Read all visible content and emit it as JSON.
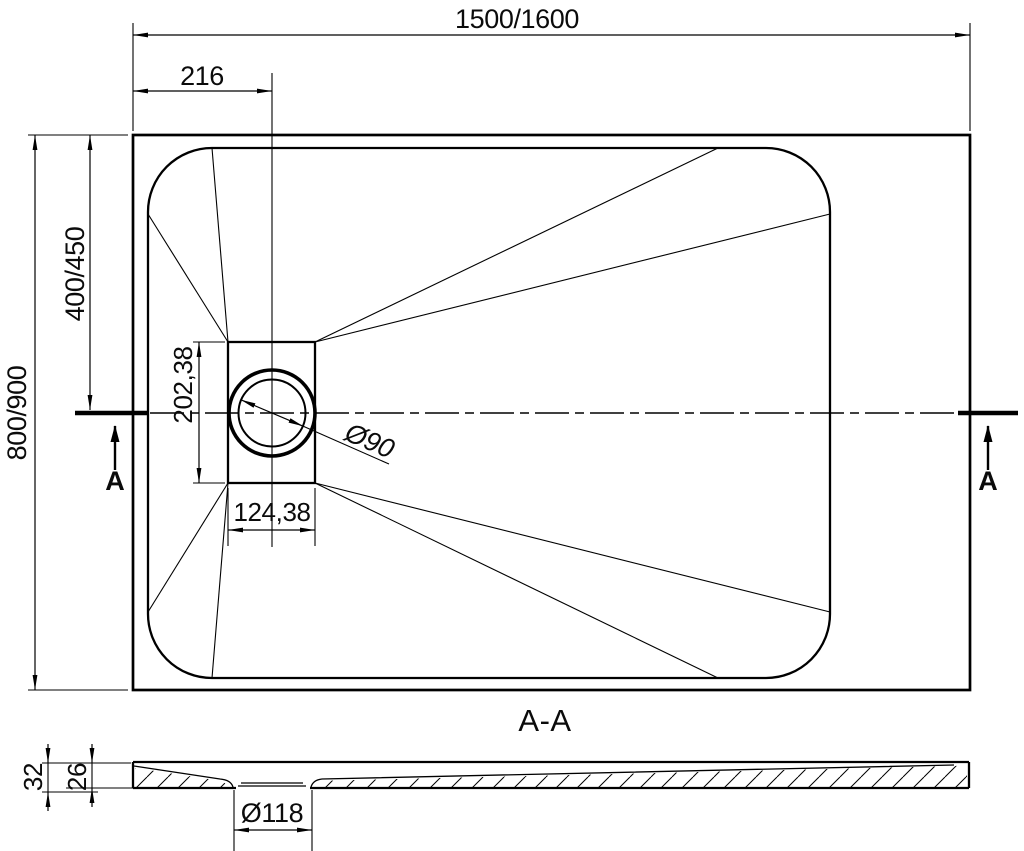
{
  "top_view": {
    "width_label": "1500/1600",
    "drain_offset_x_label": "216",
    "height_label": "800/900",
    "drain_offset_y_label": "400/450",
    "drain_box_height_label": "202,38",
    "drain_box_width_label": "124,38",
    "drain_diameter_label": "Ø90",
    "section_arrow_left_label": "A",
    "section_arrow_right_label": "A"
  },
  "section_view": {
    "title": "A-A",
    "overall_height_label": "32",
    "inner_depth_label": "26",
    "recess_diameter_label": "Ø118"
  },
  "colors": {
    "line": "#000000",
    "background": "#ffffff"
  }
}
